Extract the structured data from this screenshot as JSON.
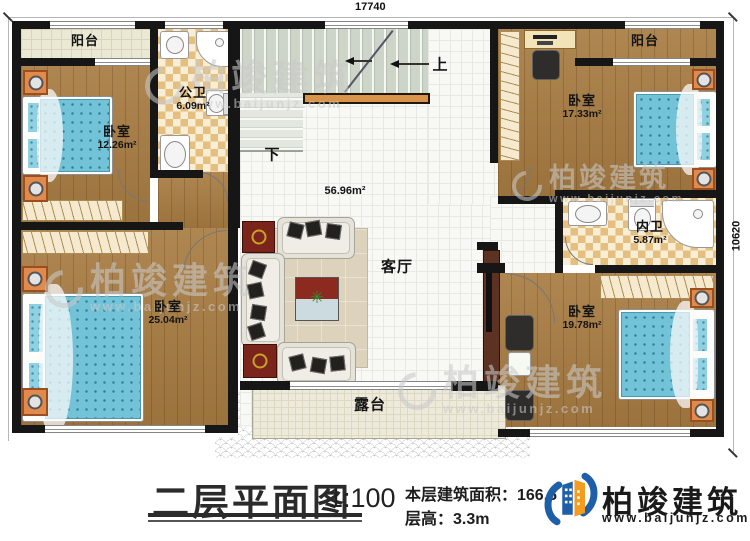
{
  "dimensions": {
    "width": "17740",
    "height": "10620"
  },
  "rooms": {
    "balcony_left": {
      "label": "阳台"
    },
    "bath_public": {
      "label": "公卫",
      "area": "6.09m²"
    },
    "bedroom_top_left": {
      "label": "卧室",
      "area": "12.26m²"
    },
    "bedroom_bottom_left": {
      "label": "卧室",
      "area": "25.04m²"
    },
    "bedroom_top_right": {
      "label": "卧室",
      "area": "17.33m²"
    },
    "bedroom_bottom_right": {
      "label": "卧室",
      "area": "19.78m²"
    },
    "balcony_right": {
      "label": "阳台"
    },
    "bath_private": {
      "label": "内卫",
      "area": "5.87m²"
    },
    "living_room": {
      "label": "客厅",
      "hall_area": "56.96m²"
    },
    "terrace": {
      "label": "露台"
    }
  },
  "stairs": {
    "up": "上",
    "down": "下"
  },
  "watermark": {
    "brand": "柏竣建筑",
    "url": "www.baijunjz.com"
  },
  "footer": {
    "title": "二层平面图",
    "scale": "1:100",
    "area_text": "本层建筑面积：166.6",
    "height_text": "层高：3.3m",
    "brand": "柏竣建筑",
    "brand_url": "www.baijunjz.com"
  },
  "colors": {
    "wall": "#161616",
    "wood_floor": "#a87c42",
    "bed_blue": "#72c2d8",
    "handrail_orange": "#d8944a",
    "logo_blue": "#1e5fa8",
    "logo_orange": "#f59b1e"
  }
}
